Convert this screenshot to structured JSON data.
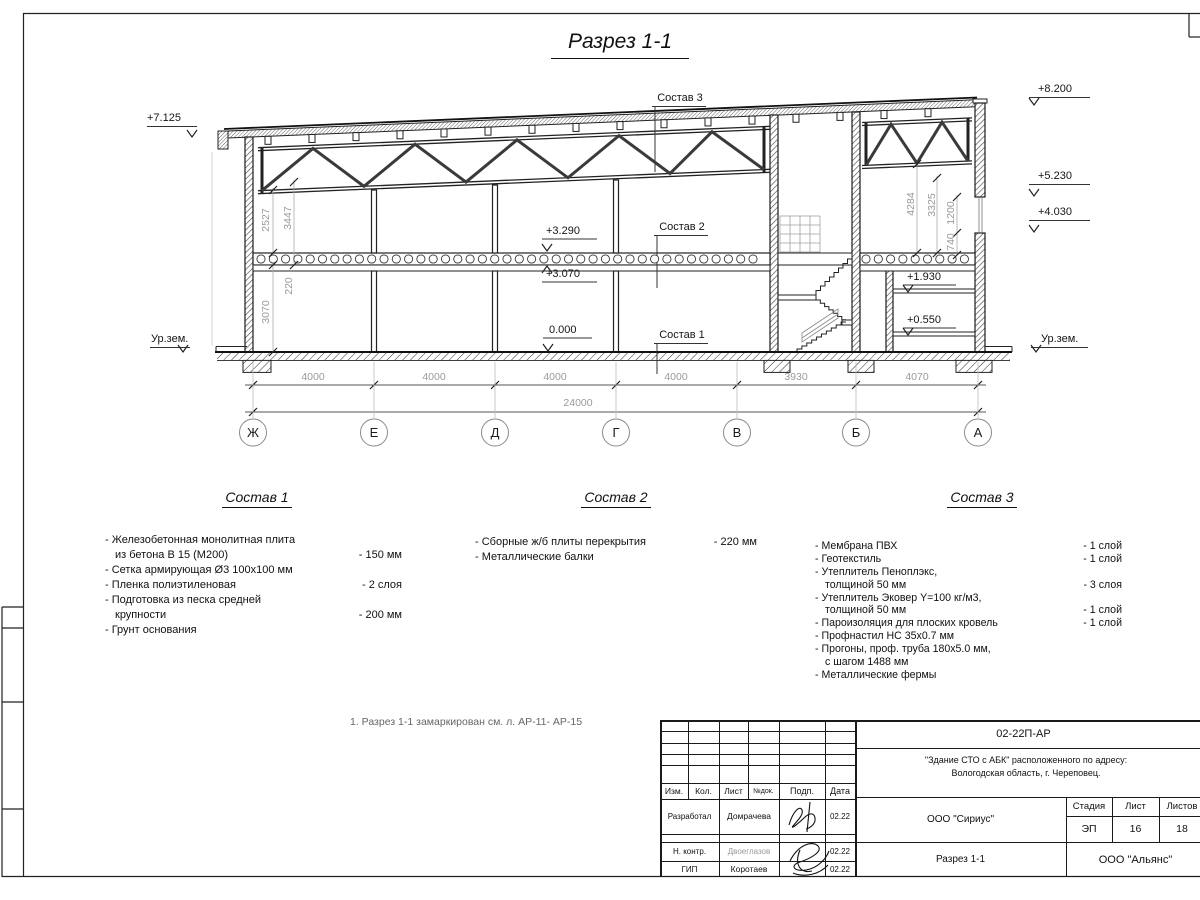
{
  "sheet": {
    "title": "Разрез 1-1",
    "note": "1. Разрез 1-1 замаркирован см. л. АР-11- АР-15"
  },
  "section": {
    "marks": {
      "m7125": "+7.125",
      "m8200": "+8.200",
      "m5230": "+5.230",
      "m4030": "+4.030",
      "m3290": "+3.290",
      "m3070": "+3.070",
      "m0000": "0.000",
      "m1930": "+1.930",
      "m0550": "+0.550",
      "ground_left": "Ур.зем.",
      "ground_right": "Ур.зем."
    },
    "leaders": {
      "s1": "Состав 1",
      "s2": "Состав 2",
      "s3": "Состав 3"
    },
    "vdims": {
      "d2527": "2527",
      "d3447": "3447",
      "d220": "220",
      "d3070": "3070",
      "d4284": "4284",
      "d3325": "3325",
      "d1200": "1200",
      "d740": "740"
    },
    "spans": [
      "4000",
      "4000",
      "4000",
      "4000",
      "3930",
      "4070"
    ],
    "total": "24000",
    "axes": [
      "Ж",
      "Е",
      "Д",
      "Г",
      "В",
      "Б",
      "А"
    ]
  },
  "compositions": [
    {
      "heading": "Состав 1",
      "items": [
        {
          "text": "- Железобетонная  монолитная плита",
          "text2": "из бетона В 15 (М200)",
          "value": "- 150 мм"
        },
        {
          "text": "- Сетка армирующая Ø3 100x100 мм",
          "value": ""
        },
        {
          "text": "- Пленка полиэтиленовая",
          "value": "- 2 слоя"
        },
        {
          "text": "- Подготовка из песка средней",
          "text2": "крупности",
          "value": "- 200 мм"
        },
        {
          "text": "- Грунт основания",
          "value": ""
        }
      ]
    },
    {
      "heading": "Состав 2",
      "items": [
        {
          "text": "- Сборные ж/б плиты перекрытия",
          "value": "- 220 мм"
        },
        {
          "text": "- Металлические балки",
          "value": ""
        }
      ]
    },
    {
      "heading": "Состав 3",
      "items": [
        {
          "text": "- Мембрана ПВХ",
          "value": "- 1 слой"
        },
        {
          "text": "- Геотекстиль",
          "value": "- 1 слой"
        },
        {
          "text": "- Утеплитель Пеноплэкс,",
          "text2": "толщиной 50 мм",
          "value": "- 3 слоя"
        },
        {
          "text": "- Утеплитель Эковер Y=100 кг/м3,",
          "text2": "толщиной 50 мм",
          "value": "- 1 слой"
        },
        {
          "text": "- Пароизоляция для плоских кровель",
          "value": "- 1 слой"
        },
        {
          "text": "- Профнастил НС 35x0.7 мм",
          "value": ""
        },
        {
          "text": "- Прогоны, проф. труба 180x5.0 мм,",
          "text2": "с шагом 1488 мм",
          "value": ""
        },
        {
          "text": "- Металлические фермы",
          "value": ""
        }
      ]
    }
  ],
  "stamp": {
    "doc_code": "02-22П-АР",
    "project_line1": "\"Здание СТО с АБК\" расположенного по адресу:",
    "project_line2": "Вологодская область, г. Череповец.",
    "col_izm": "Изм.",
    "col_kol": "Кол.",
    "col_list": "Лист",
    "col_doc": "№док.",
    "col_podp": "Подп.",
    "col_data": "Дата",
    "rows": [
      {
        "role": "Разработал",
        "name": "Домрачева",
        "date": "02.22"
      },
      {
        "role": "Н. контр.",
        "name": "Двоеглазов",
        "date": "02.22"
      },
      {
        "role": "ГИП",
        "name": "Коротаев",
        "date": "02.22"
      }
    ],
    "org_design": "ООО \"Сириус\"",
    "sheet_title": "Разрез 1-1",
    "org_contractor": "ООО \"Альянс\"",
    "stage_label": "Стадия",
    "sheet_label": "Лист",
    "sheets_label": "Листов",
    "stage": "ЭП",
    "sheet_no": "16",
    "sheets_total": "18"
  }
}
